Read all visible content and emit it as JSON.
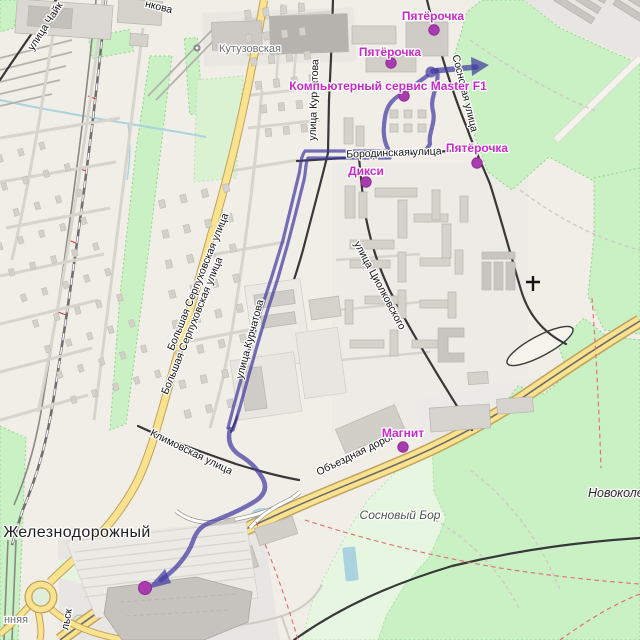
{
  "poi": {
    "pyaterochka_top": "Пятёрочка",
    "pyaterochka_mid": "Пятёрочка",
    "pyaterochka_east": "Пятёрочка",
    "master_f1": "Компьютерный сервис Master F1",
    "diksi": "Дикси",
    "magnit": "Магнит"
  },
  "streets": {
    "borodinskaya": "Бородинская улица",
    "sosnovaya": "Сосновая улица",
    "kurchatova_north": "улица Курчатова",
    "kurchatova_south": "улица Курчатова",
    "serpukhovskaya_a": "Большая Серпуховская улица",
    "serpukhovskaya_b": "Большая Серпуховская улица",
    "tsiolkovskogo": "улица Циолковского",
    "klimovskaya": "Климовская улица",
    "obyezdnaya": "Объездная дорога",
    "chayki_partial": "улица Чайк"
  },
  "places": {
    "zheleznodorozhny": "Железнодорожный",
    "kutuzovskaya_station": "Кутузовская",
    "sosnovy_bor": "Сосновый Бор",
    "novokoledino_partial": "Новоколеди"
  },
  "partial_labels": {
    "top_edge": "нкова",
    "bottom_left_street": "нняя",
    "road_by_roundabout": "льск"
  },
  "icons": {
    "station": "railway-station-icon",
    "church": "church-cross-icon",
    "route_arrow": "route-direction-arrow"
  },
  "colors": {
    "route": "#413CA0",
    "poi_text": "#CB28CB",
    "poi_dot": "#A83CAE",
    "road_main": "#FBE28F",
    "green": "#C9F1C4",
    "water": "#AAD3DF"
  }
}
